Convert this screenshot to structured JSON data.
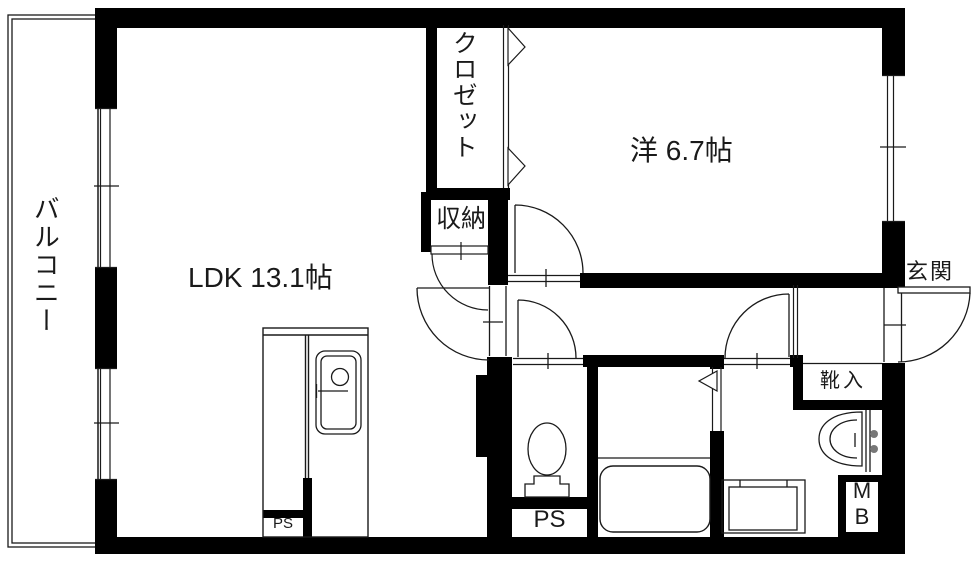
{
  "floorplan": {
    "title": "apartment-floor-plan",
    "rooms": {
      "balcony": {
        "label": "バルコニー"
      },
      "ldk": {
        "label": "LDK 13.1帖"
      },
      "closet": {
        "label": "クロゼット"
      },
      "storage": {
        "label": "収納"
      },
      "western_room": {
        "label": "洋 6.7帖"
      },
      "entrance": {
        "label": "玄関"
      },
      "shoe_cabinet": {
        "label": "靴入"
      },
      "pipe_space_toilet": {
        "label": "PS"
      },
      "pipe_space_kitchen": {
        "label": "PS"
      },
      "meter_box": {
        "letters": [
          "M",
          "B"
        ]
      }
    },
    "colors": {
      "wall": "#000000",
      "background": "#ffffff",
      "line": "#1a1a1a",
      "outlet_dot": "#777777"
    }
  }
}
